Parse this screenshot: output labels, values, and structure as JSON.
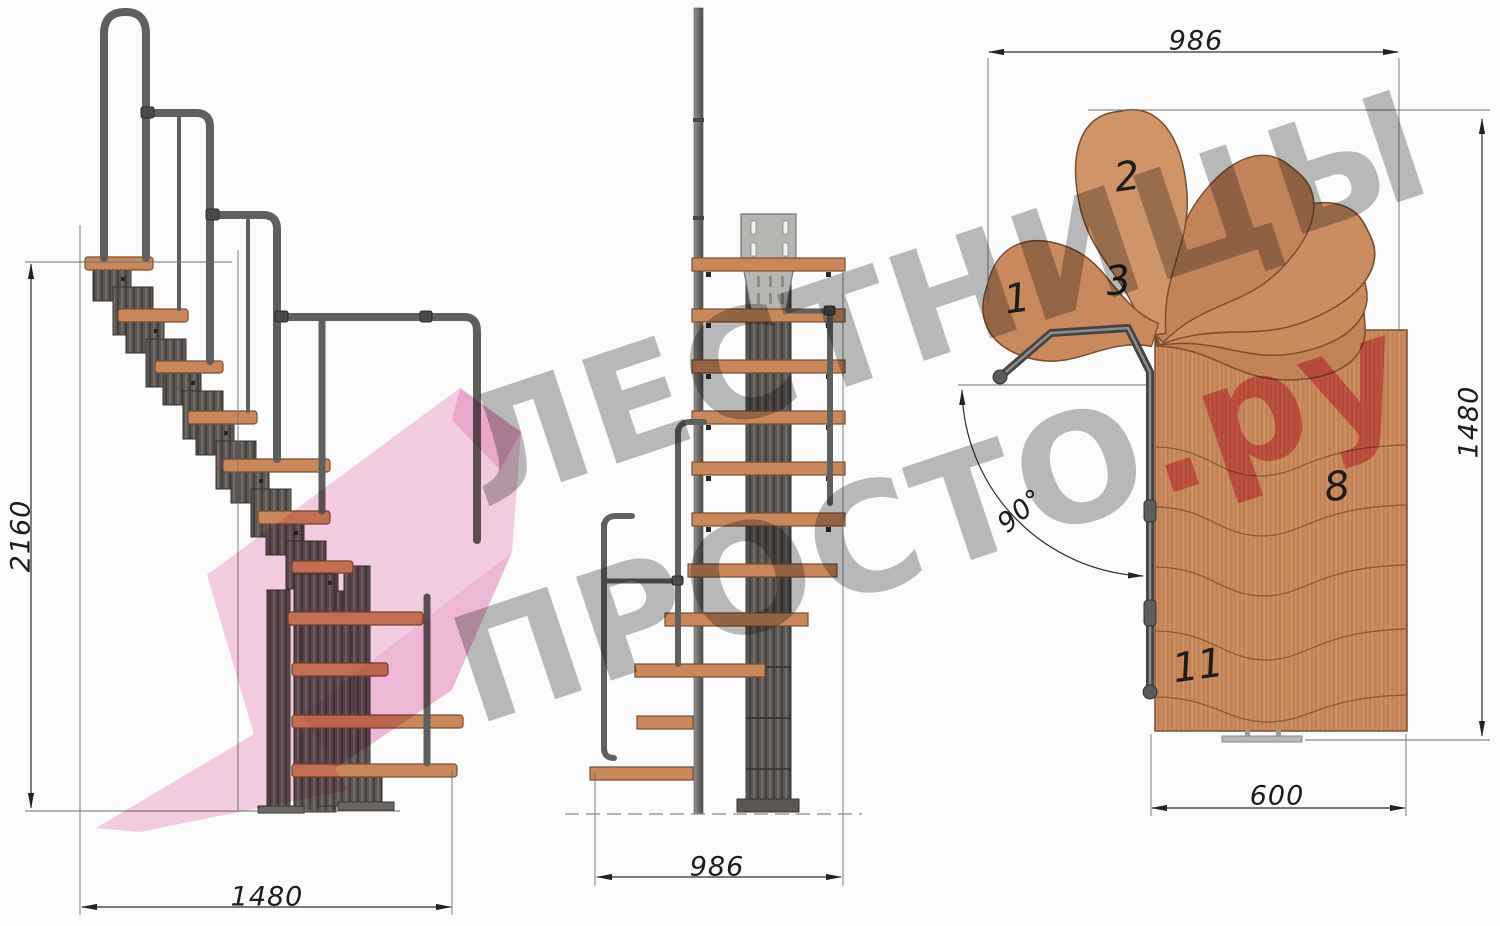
{
  "watermark": {
    "line1": "ЛЕСТНИЦЫ",
    "line2_gray": "ПРОСТО",
    "line2_red": ".ру",
    "gray_color": "#7c7c7c",
    "red_color": "#e03a5f",
    "ribbon_pink": "#f5c3dc"
  },
  "dimensions": {
    "side_height": "2160",
    "side_length": "1480",
    "front_width": "986",
    "plan_width": "986",
    "plan_depth": "1480",
    "plan_flight_width": "600",
    "plan_turn_angle": "90°"
  },
  "plan_step_numbers": {
    "s1": "1",
    "s2": "2",
    "s3": "3",
    "s8": "8",
    "s11": "11"
  },
  "colors": {
    "wood": "#c8895d",
    "metal_dark": "#55504d",
    "metal_light": "#8f8f8d",
    "dimension_line": "#2c2c2c",
    "background": "#fbfbfc"
  }
}
